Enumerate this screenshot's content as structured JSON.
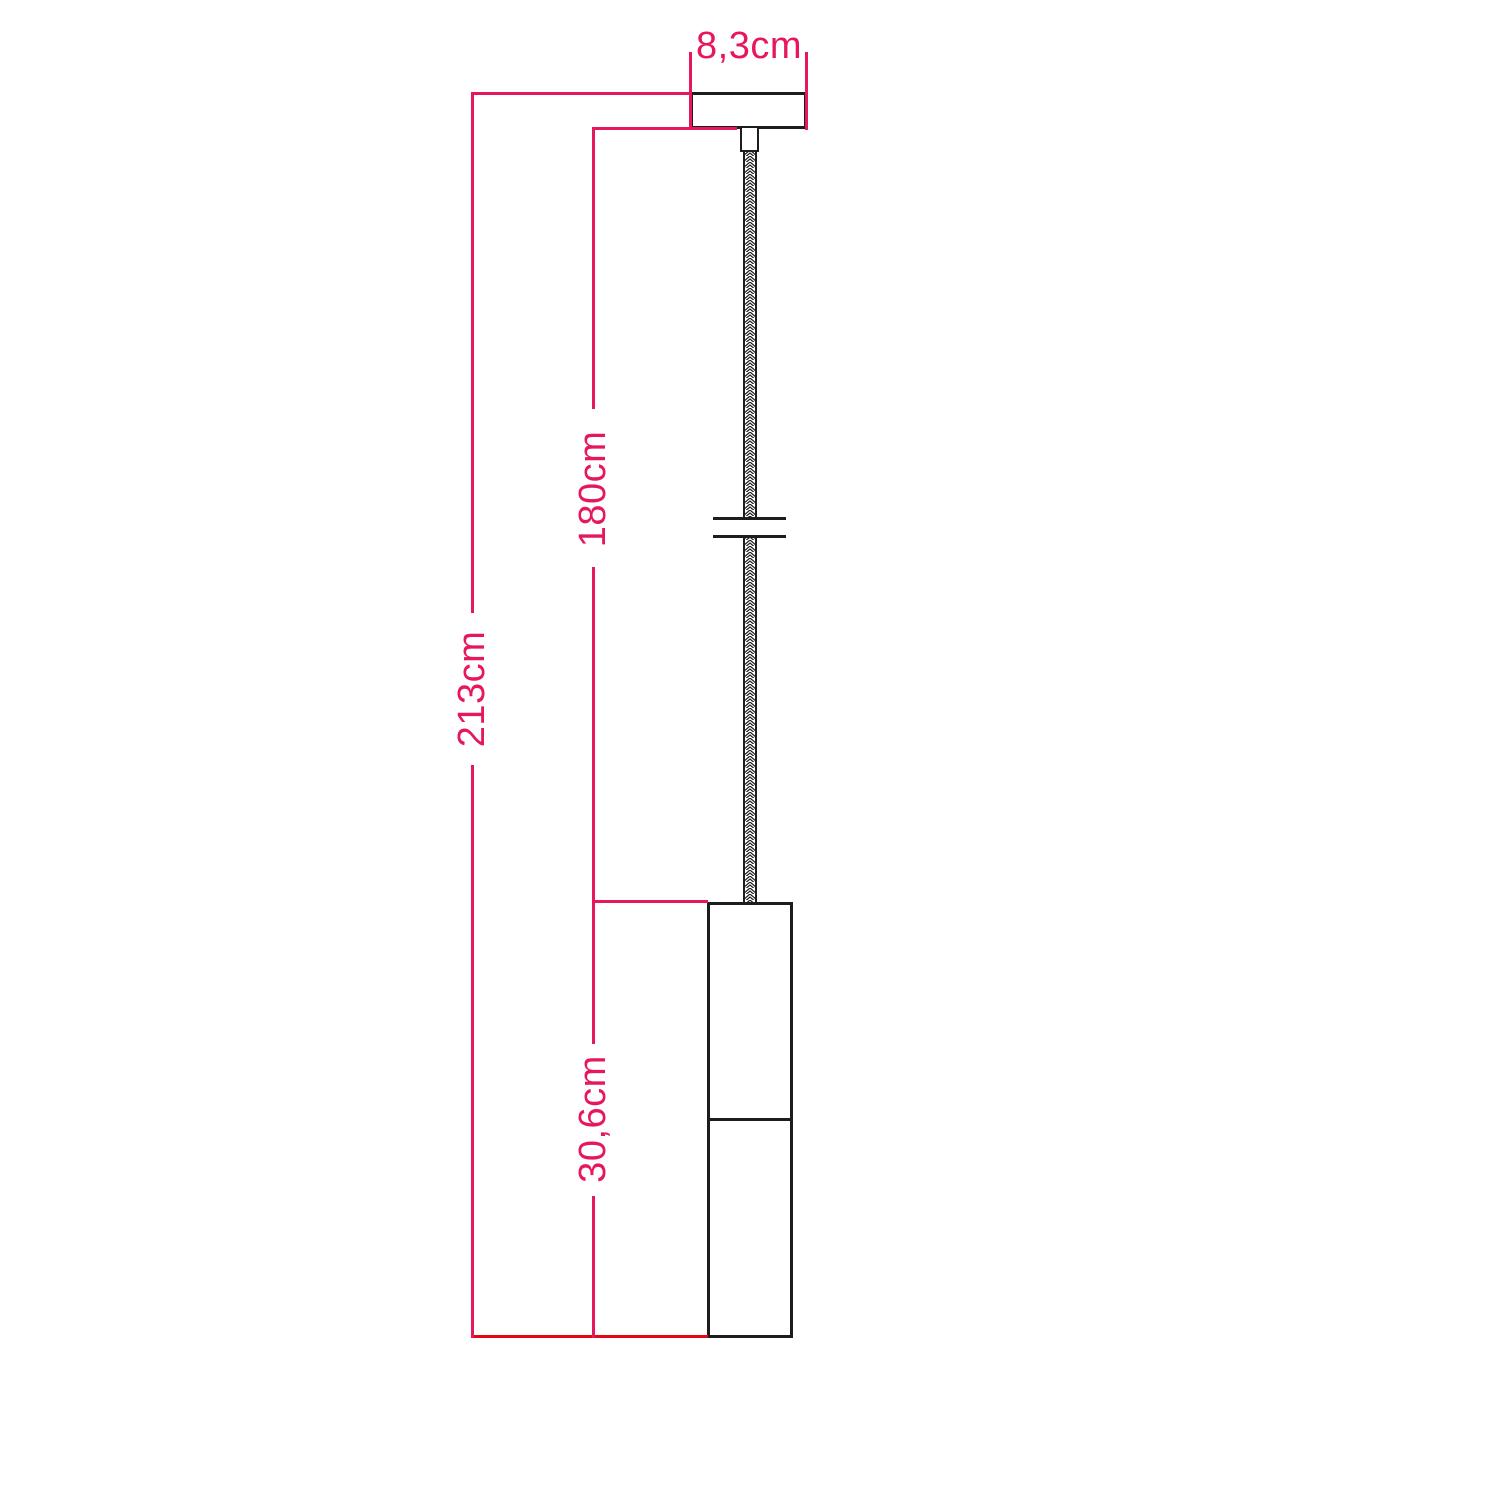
{
  "page": {
    "kind": "pendant lamp technical dimension drawing",
    "background": "#ffffff"
  },
  "colors": {
    "dimension_pink": "#e7175e",
    "baseline_red": "#e30613",
    "outline_black": "#1d1d1b"
  },
  "dimensions": {
    "width": {
      "label": "8,3cm",
      "value_cm": 8.3
    },
    "cable_length": {
      "label": "180cm",
      "value_cm": 180
    },
    "total_height": {
      "label": "213cm",
      "value_cm": 213
    },
    "lamp_height": {
      "label": "30,6cm",
      "value_cm": 30.6
    }
  }
}
